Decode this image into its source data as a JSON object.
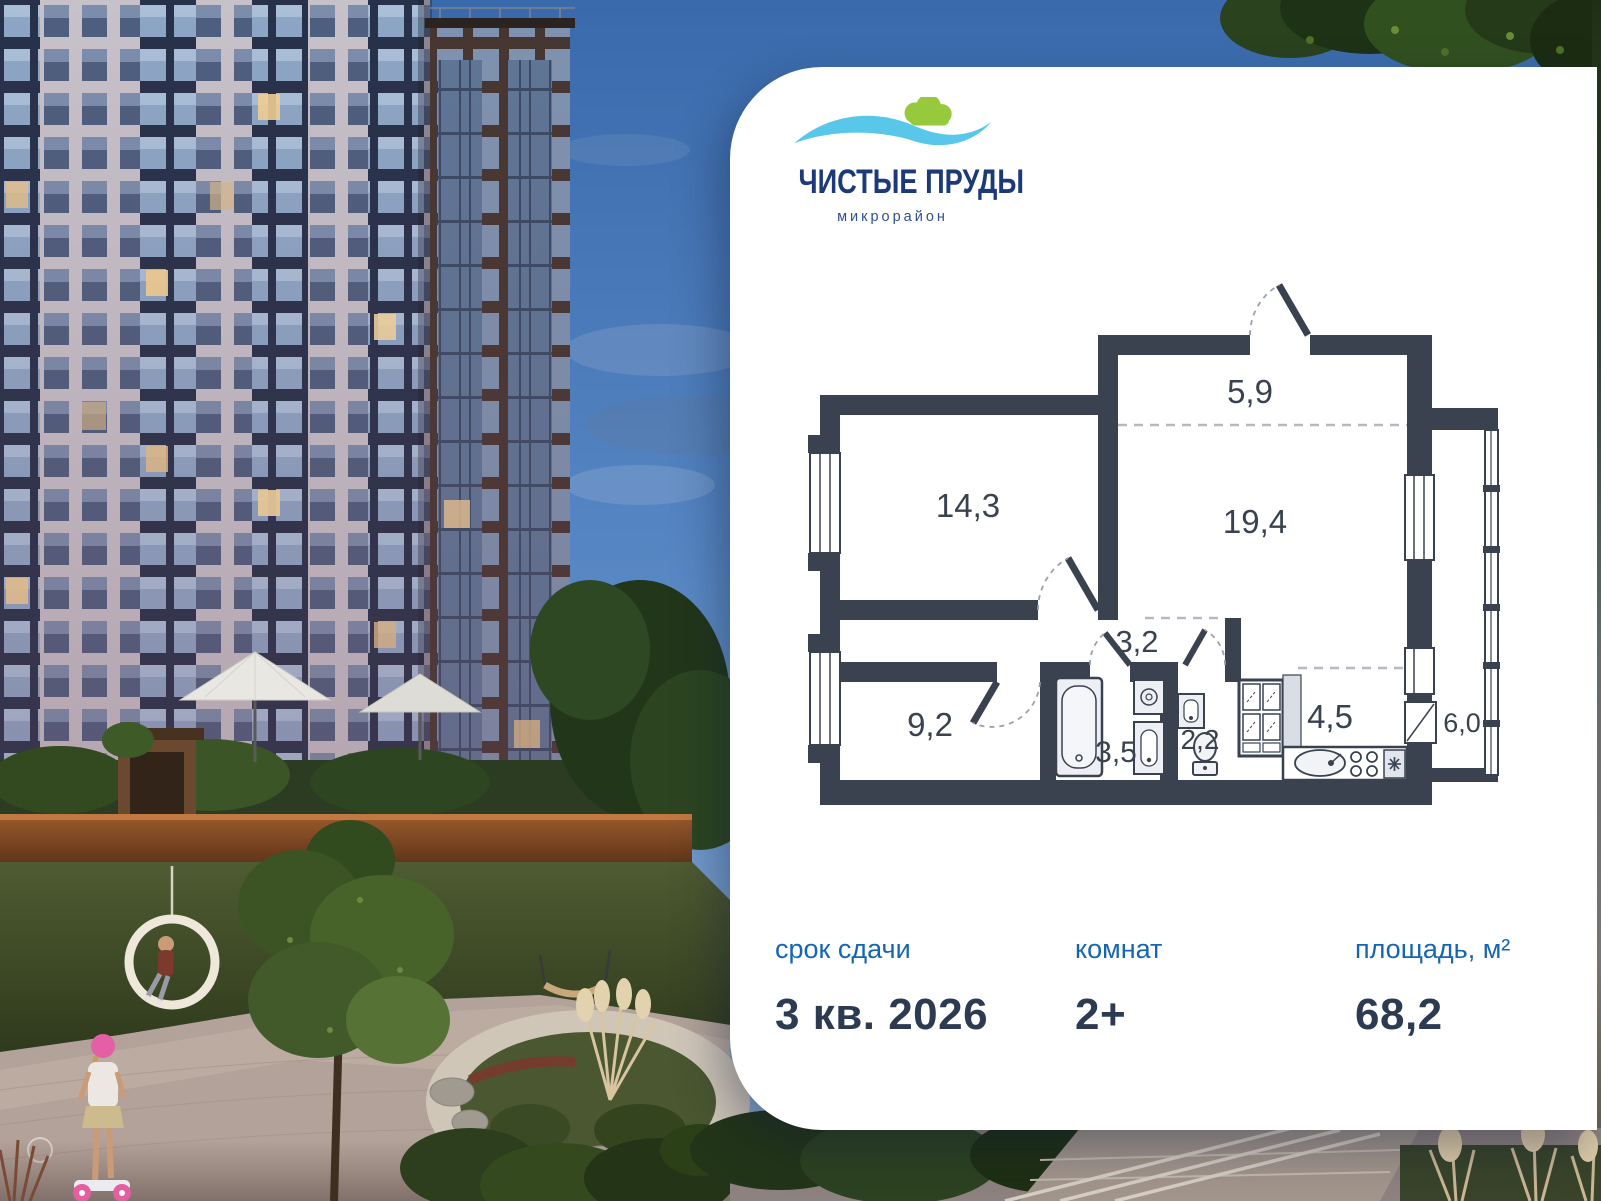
{
  "logo": {
    "title": "ЧИСТЫЕ ПРУДЫ",
    "subtitle": "микрорайон",
    "colors": {
      "wave": "#59C7E9",
      "bush": "#97C93D",
      "title": "#1C3A78"
    }
  },
  "floor_plan": {
    "wall_color": "#3A4250",
    "rooms": [
      {
        "id": "entry-hall",
        "area": "5,9"
      },
      {
        "id": "bedroom-1",
        "area": "14,3"
      },
      {
        "id": "living-room",
        "area": "19,4"
      },
      {
        "id": "corridor",
        "area": "3,2"
      },
      {
        "id": "bedroom-2",
        "area": "9,2"
      },
      {
        "id": "bathroom",
        "area": "3,5"
      },
      {
        "id": "wc",
        "area": "2,2"
      },
      {
        "id": "kitchen",
        "area": "4,5"
      },
      {
        "id": "balcony",
        "area": "6,0"
      }
    ]
  },
  "stats": [
    {
      "label": "срок сдачи",
      "value": "3 кв. 2026"
    },
    {
      "label": "комнат",
      "value": "2+"
    },
    {
      "label": "площадь, м²",
      "value": "68,2"
    }
  ],
  "colors": {
    "card_bg": "#FFFFFF",
    "label_blue": "#1566B2",
    "value_dark": "#2D3B52",
    "plan_walls": "#3A4250",
    "sky": "#4A76B4",
    "string_lights": "#FFE3A1"
  }
}
